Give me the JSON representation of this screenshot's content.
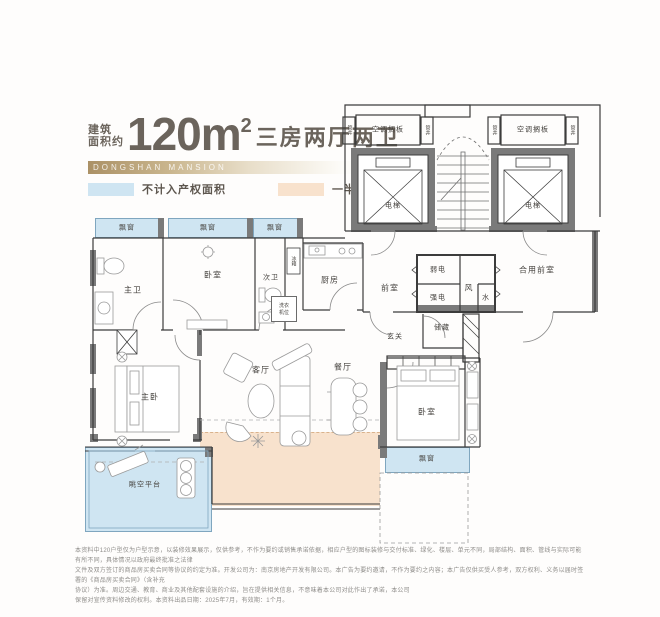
{
  "header": {
    "area_label_line1": "建筑",
    "area_label_line2": "面积约",
    "area_value": "120m",
    "area_sup": "2",
    "title_suffix": "三房两厅两卫",
    "brand": "DONGSHAN MANSION"
  },
  "legend": {
    "not_counted_label": "不计入产权面积",
    "not_counted_color": "#cfe5f2",
    "half_counted_label": "一半计入产权面积",
    "half_counted_color": "#f8e2cd"
  },
  "plan": {
    "labels": {
      "ac_shelf_left": "空调搁板",
      "ac_shelf_right": "空调搁板",
      "duct": "管井",
      "elevator_left": "电梯",
      "elevator_right": "电梯",
      "bay_window_1": "飘窗",
      "bay_window_2": "飘窗",
      "bay_window_3": "飘窗",
      "bay_window_right": "飘窗",
      "master_bath": "主卫",
      "bedroom_top": "卧室",
      "second_bath": "次卫",
      "kitchen": "厨房",
      "fridge": "冰箱",
      "washer_line1": "洗衣",
      "washer_line2": "机位",
      "front_room": "前室",
      "weak_power": "弱电",
      "strong_power": "强电",
      "vent": "风",
      "water": "水",
      "shared_front_room": "合用前室",
      "entry": "玄关",
      "storage": "储藏",
      "living_room": "客厅",
      "dining_room": "餐厅",
      "master_bedroom": "主卧",
      "bedroom_right": "卧室",
      "sky_platform": "眺空平台"
    },
    "wall_color": "#3c3c3c",
    "structure_color": "#7a7a7a"
  },
  "footer": {
    "disclaimer_lines": [
      "本资料中120户型仅为户型示意，以装修效果展示，仅供参考，不作为要约或销售承诺依据，相应户型的图标装修与交付标准、绿化、楼层、单元不同，局部结构、面积、管线与实际可能有所不同，具体情况以政府最终批准之法律",
      "文件及双方签订的商品房买卖合同等协议的约定为准。开发公司为：南京房地产开发有限公司。本广告为要约邀请，不作为要约之内容；本广告仅供买受人参考，双方权利、义务以届时签署的《商品房买卖合同》（含补充",
      "协议）为准。周边交通、教育、商业及其他配套设施的介绍，旨在提供相关信息，不意味着本公司对此作出了承诺，本公司",
      "保留对宣传资料修改的权利。本资料出品日期：2025年7月，有效期：1个月。"
    ]
  }
}
